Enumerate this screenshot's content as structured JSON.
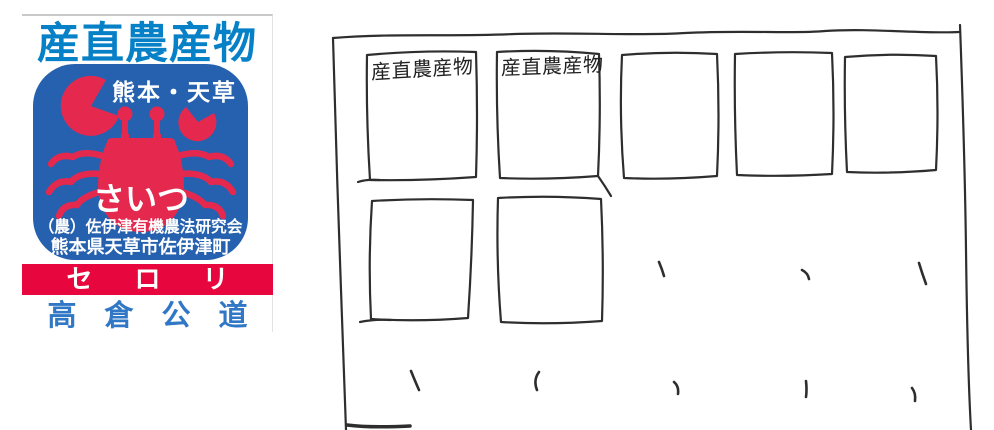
{
  "label": {
    "heading": "産直農産物",
    "region": "熊本・天草",
    "mascot_text": "さいつ",
    "org_line1": "（農）佐伊津有機農法研究会",
    "org_line2": "熊本県天草市佐伊津町",
    "product": "セロリ",
    "producer": "高倉公道",
    "colors": {
      "heading_blue": "#0680c6",
      "panel_blue": "#2561ae",
      "crab_red": "#e5294e",
      "banner_red": "#e8063e",
      "producer_blue": "#3077c6"
    }
  },
  "sketch": {
    "stroke_color": "#2e2e2e",
    "grid": {
      "row1_cells": 5,
      "row2_cells": 2
    },
    "cells": [
      {
        "row": 1,
        "col": 1,
        "text": "産直農産物"
      },
      {
        "row": 1,
        "col": 2,
        "text": "産直農産物"
      },
      {
        "row": 1,
        "col": 3,
        "text": ""
      },
      {
        "row": 1,
        "col": 4,
        "text": ""
      },
      {
        "row": 1,
        "col": 5,
        "text": ""
      },
      {
        "row": 2,
        "col": 1,
        "text": ""
      },
      {
        "row": 2,
        "col": 2,
        "text": ""
      }
    ],
    "tick_marks": 8
  }
}
